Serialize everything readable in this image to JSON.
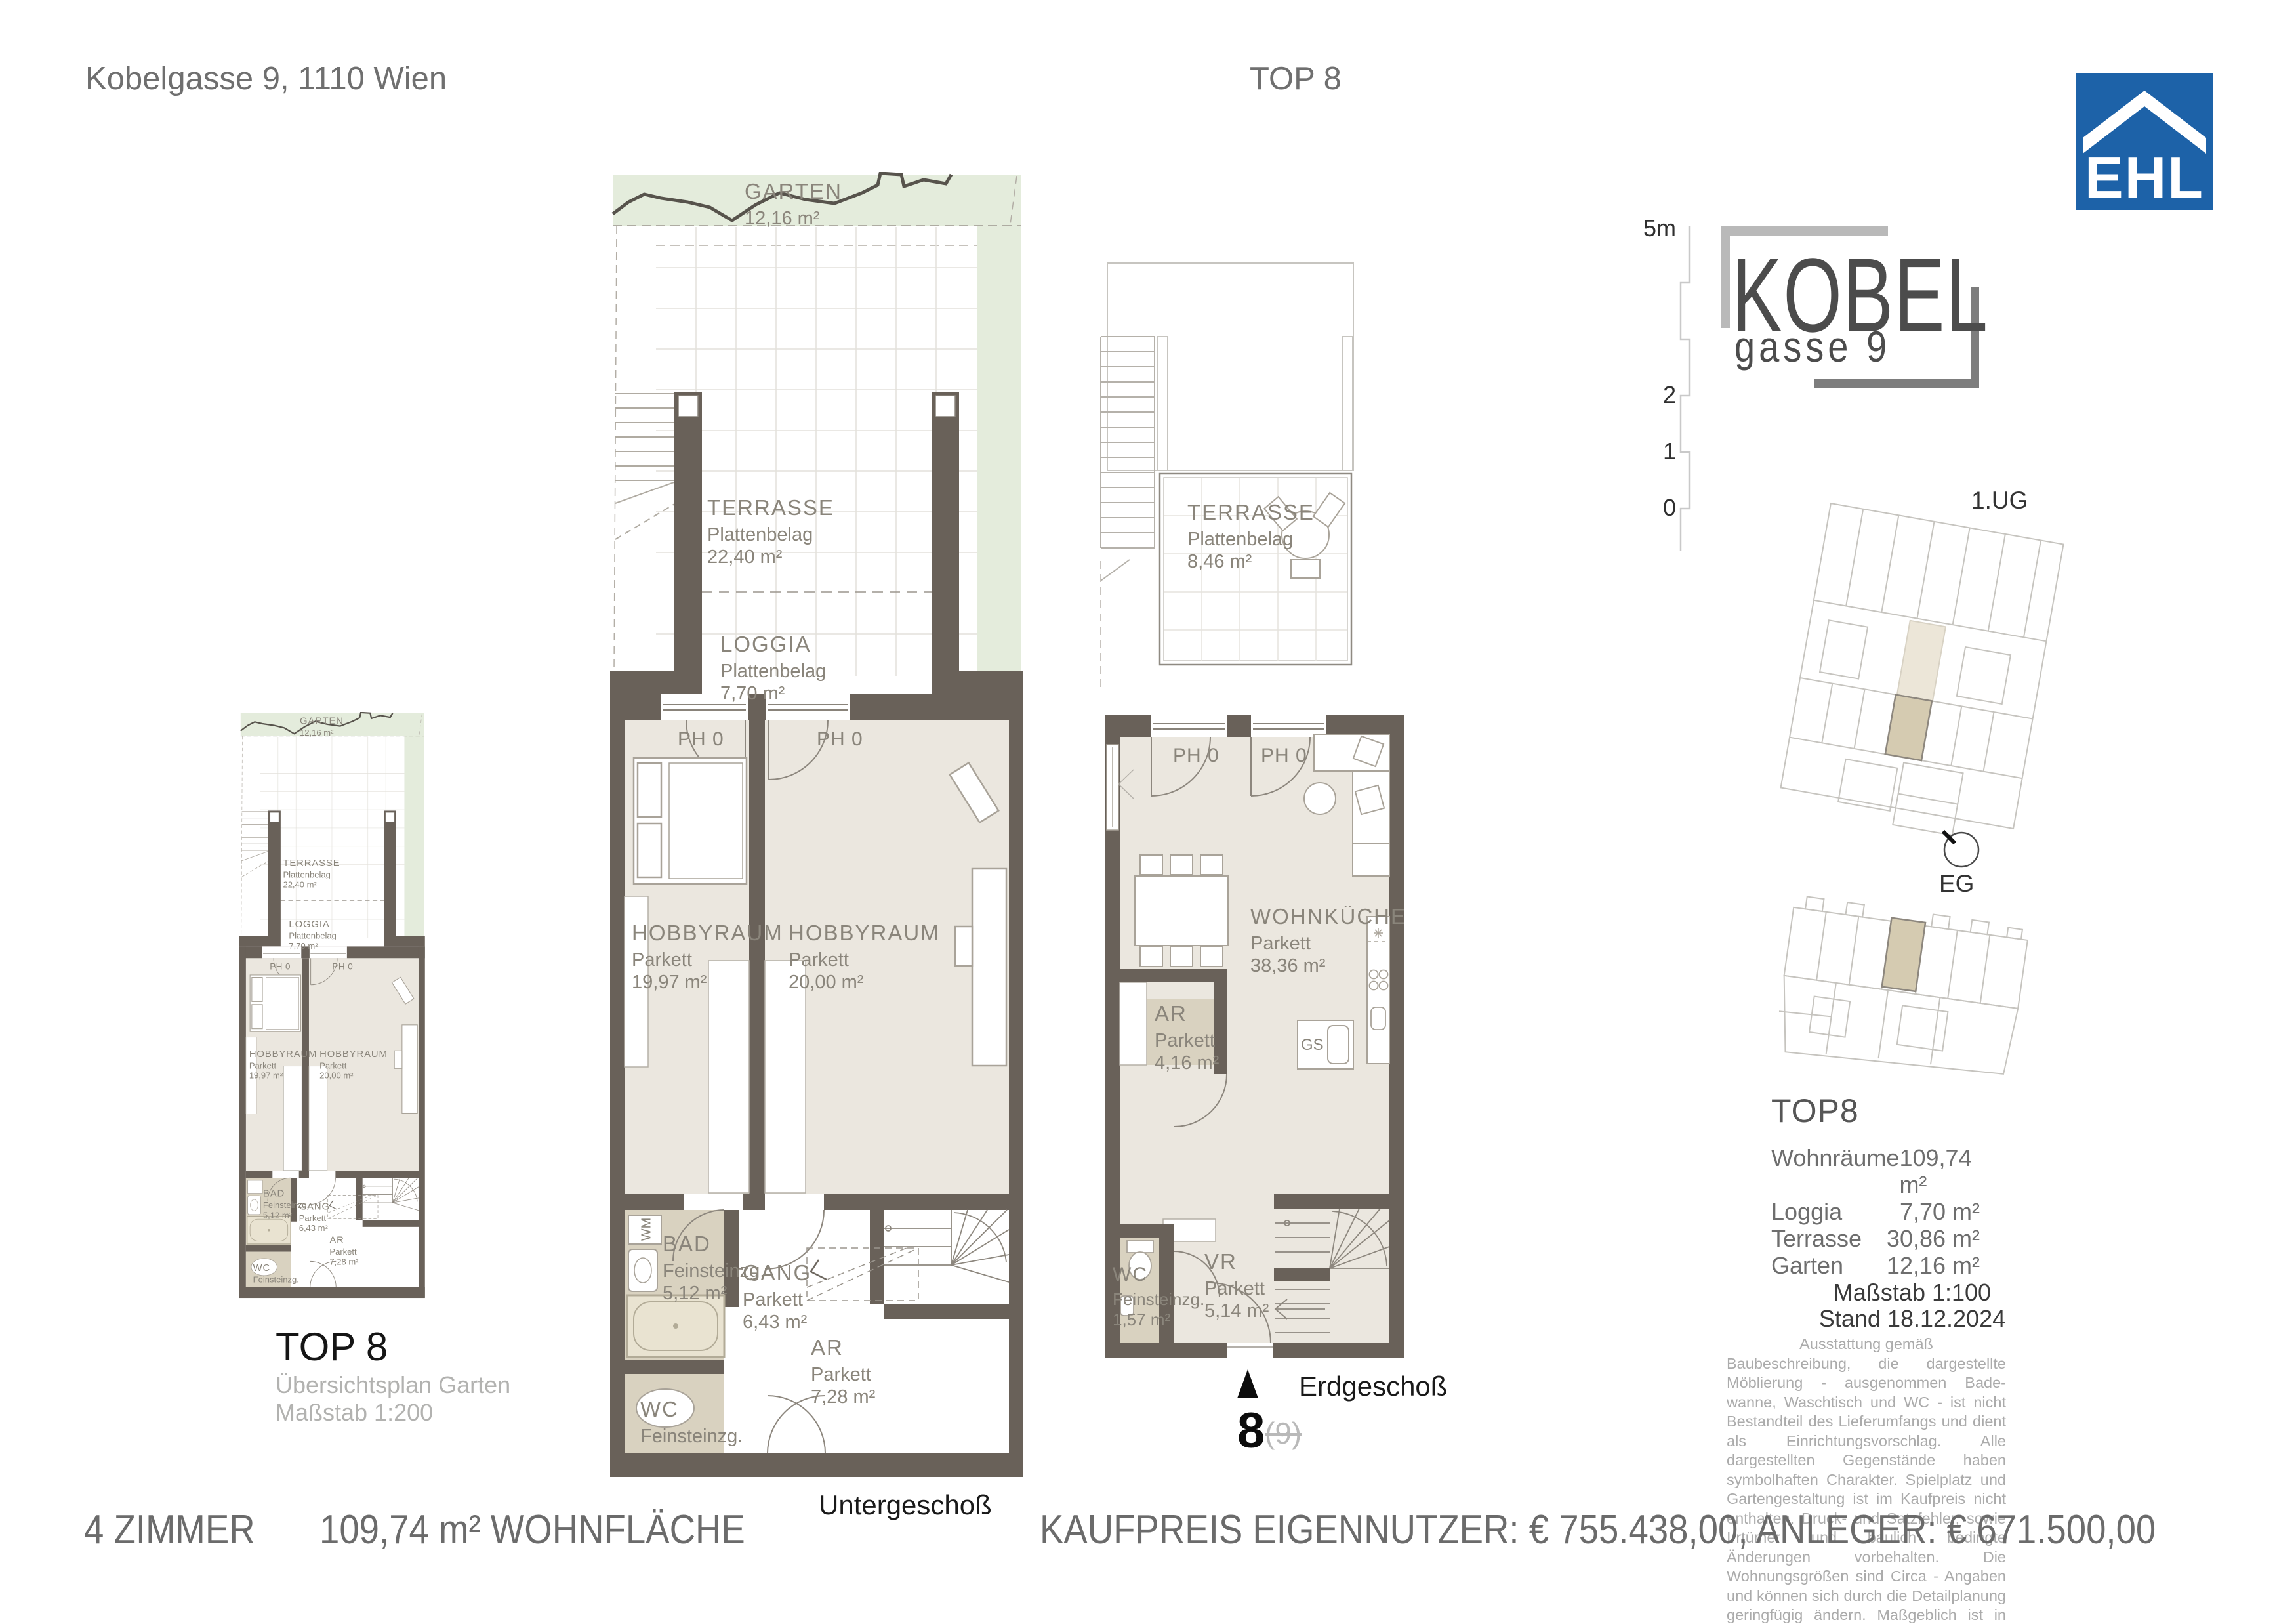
{
  "header": {
    "address": "Kobelgasse 9, 1110 Wien",
    "unit": "TOP 8"
  },
  "branding": {
    "ehl_logo_text": "EHL",
    "ehl_blue": "#1d62a8",
    "project_name_line1": "KOBEL",
    "project_name_line2": "gasse 9"
  },
  "scale_ruler": {
    "top_label": "5m",
    "label_2": "2",
    "label_1": "1",
    "label_0": "0"
  },
  "site_plans": {
    "ug_label": "1.UG",
    "eg_label": "EG",
    "highlight_color": "#d5cbb1"
  },
  "overview": {
    "title": "TOP 8",
    "subtitle": "Übersichtsplan Garten",
    "scale_note": "Maßstab 1:200"
  },
  "ug": {
    "floor_label": "Untergeschoß",
    "garten": {
      "name": "GARTEN",
      "area": "12,16 m²"
    },
    "terrasse": {
      "name": "TERRASSE",
      "finish": "Plattenbelag",
      "area": "22,40 m²"
    },
    "loggia": {
      "name": "LOGGIA",
      "finish": "Plattenbelag",
      "area": "7,70 m²"
    },
    "ph_left": "PH 0",
    "ph_right": "PH 0",
    "hobby_left": {
      "name": "HOBBYRAUM",
      "finish": "Parkett",
      "area": "19,97 m²"
    },
    "hobby_right": {
      "name": "HOBBYRAUM",
      "finish": "Parkett",
      "area": "20,00 m²"
    },
    "bad": {
      "name": "BAD",
      "finish": "Feinsteinzg.",
      "area": "5,12 m²"
    },
    "gang": {
      "name": "GANG",
      "finish": "Parkett",
      "area": "6,43 m²"
    },
    "ar": {
      "name": "AR",
      "finish": "Parkett",
      "area": "7,28 m²"
    },
    "wc": {
      "name": "WC",
      "finish": "Feinsteinzg."
    },
    "wm": "WM"
  },
  "eg": {
    "floor_label": "Erdgeschoß",
    "terrasse": {
      "name": "TERRASSE",
      "finish": "Plattenbelag",
      "area": "8,46 m²"
    },
    "ph_left": "PH 0",
    "ph_right": "PH 0",
    "wohnkueche": {
      "name": "WOHNKÜCHE",
      "finish": "Parkett",
      "area": "38,36 m²"
    },
    "ar": {
      "name": "AR",
      "finish": "Parkett",
      "area": "4,16 m²"
    },
    "wc": {
      "name": "WC",
      "finish": "Feinsteinzg.",
      "area": "1,57 m²"
    },
    "vr": {
      "name": "VR",
      "finish": "Parkett",
      "area": "5,14 m²"
    },
    "gs": "GS",
    "unit_number": "8",
    "unit_number_old": "(9)"
  },
  "unit_info": {
    "title": "TOP8",
    "rows": [
      {
        "label": "Wohnräume",
        "value": "109,74 m²"
      },
      {
        "label": "Loggia",
        "value": "7,70 m²"
      },
      {
        "label": "Terrasse",
        "value": "30,86 m²"
      },
      {
        "label": "Garten",
        "value": "12,16 m²"
      }
    ],
    "scale_note": "Maßstab 1:100",
    "date_note": "Stand 18.12.2024",
    "disclaimer_intro": "Ausstattung gemäß",
    "disclaimer": "Baubeschreibung, die dargestellte Möblierung - ausgenommen Bade-wanne, Waschtisch und WC - ist nicht Bestandteil des Lieferumfangs und dient als Einrichtungsvorschlag. Alle dargestellten Gegenstände haben symbolhaften Charakter. Spielplatz und Gartengestaltung ist im Kaufpreis nicht enthalten. Druck- und Satzfehler, sowie Irrtümer und baulich bedingte Änderungen vorbehalten. Die Wohnungsgrößen sind Circa - Angaben und können sich durch die Detailplanung geringfügig ändern. Maßgeblich ist in jedem Fall der Kaufvertrag."
  },
  "footer": {
    "rooms": "4 ZIMMER",
    "area": "109,74 m² WOHNFLÄCHE",
    "price": "KAUFPREIS EIGENNUTZER: € 755.438,00, ANLEGER: € 671.500,00"
  },
  "colors": {
    "wall": "#696159",
    "floor": "#ebe7df",
    "wet_room": "#d9d2c0",
    "garden": "#e4ecdc",
    "label_gray": "#8a857b"
  }
}
